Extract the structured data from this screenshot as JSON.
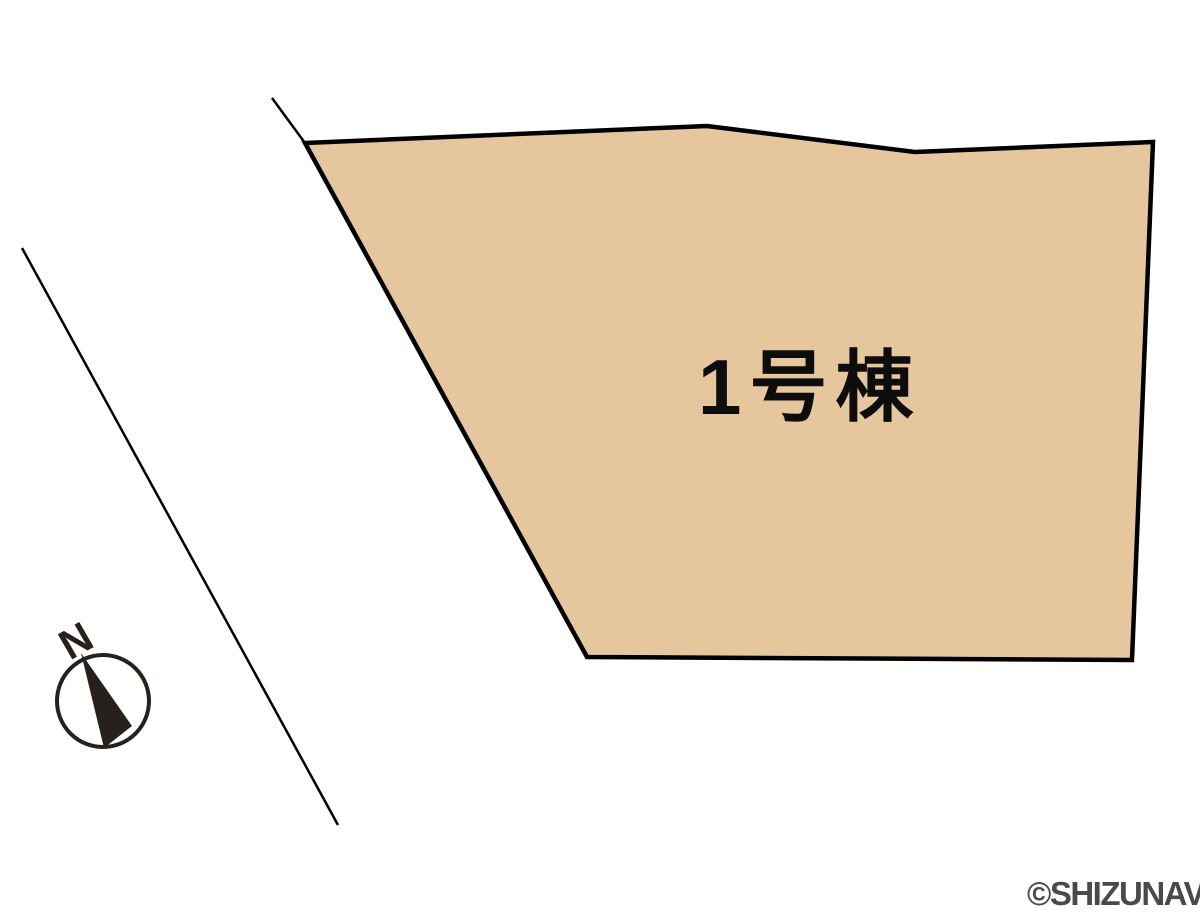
{
  "page": {
    "background_color": "#ffffff",
    "type_label": "site-plan"
  },
  "plot": {
    "label": "1号棟",
    "fill_color": "#e5c69d",
    "stroke_color": "#000000",
    "label_color": "#0d0d0d"
  },
  "compass": {
    "north_label": "N",
    "color": "#27201c"
  },
  "watermark": {
    "text": "©SHIZUNAVI",
    "color": "#4a4a48"
  },
  "boundary": {
    "line_color": "#000000"
  }
}
